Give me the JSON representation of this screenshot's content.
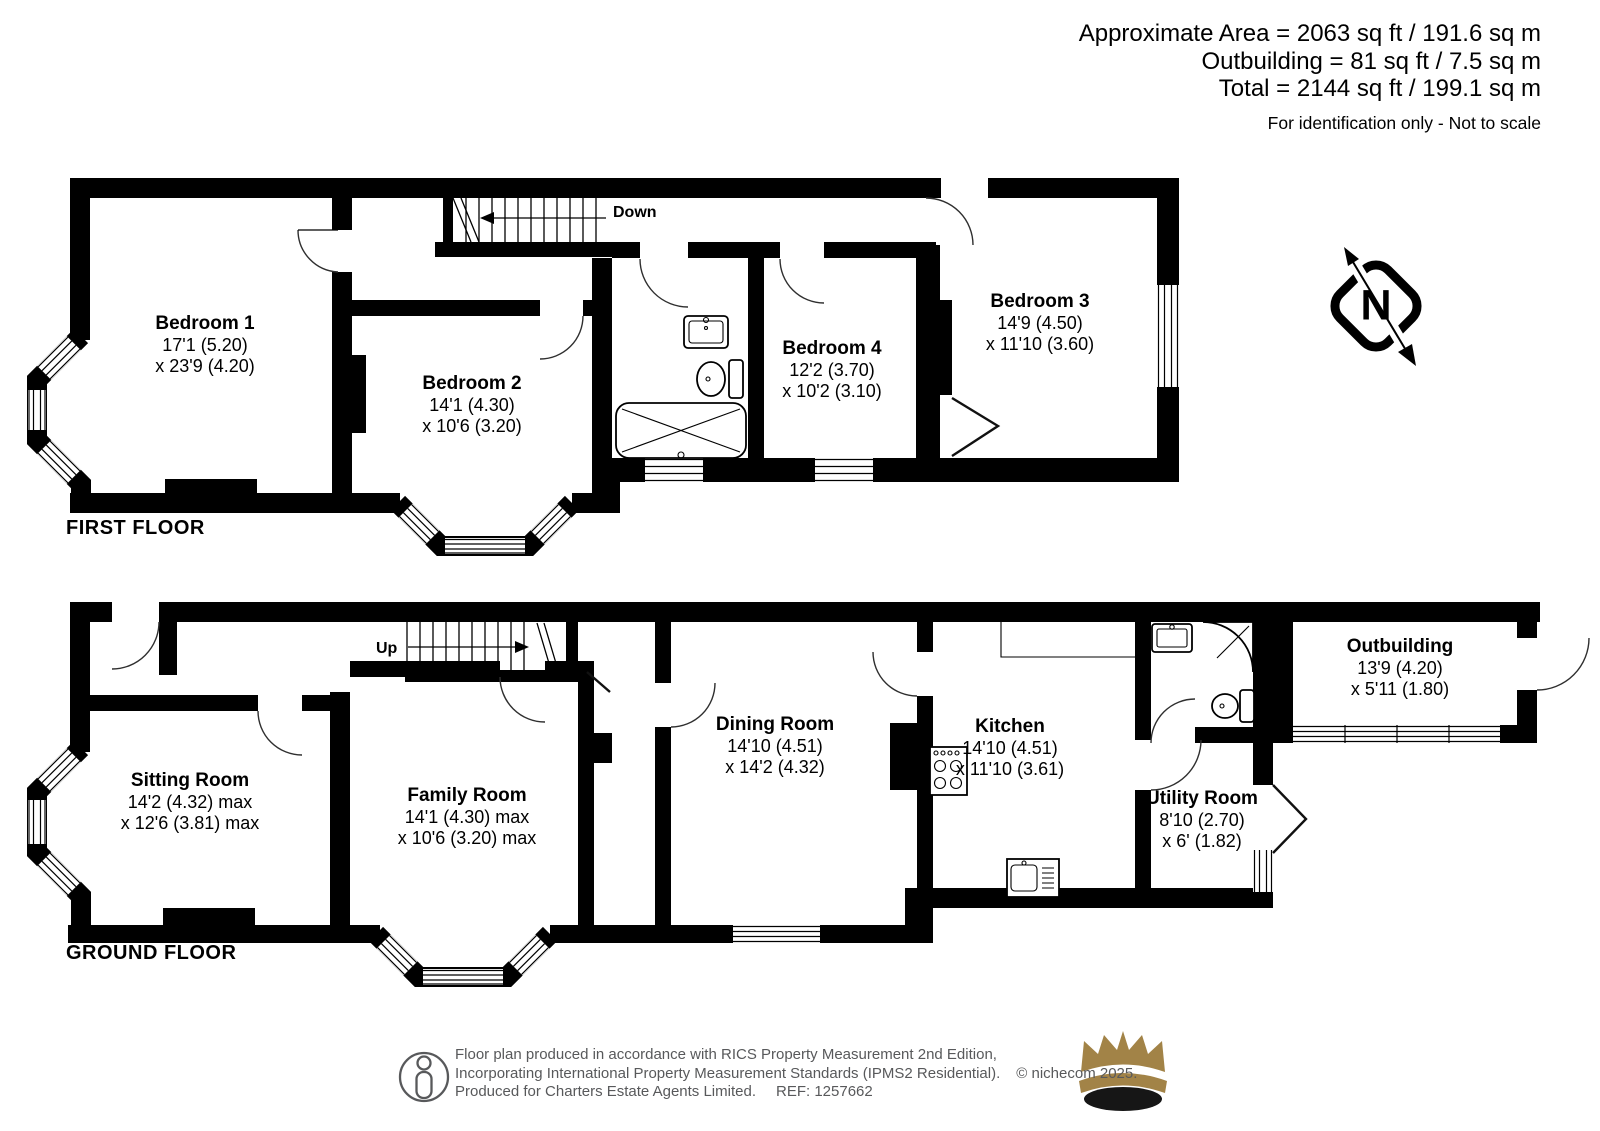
{
  "header": {
    "line1": "Approximate Area = 2063 sq ft / 191.6 sq m",
    "line2": "Outbuilding = 81 sq ft / 7.5 sq m",
    "line3": "Total = 2144 sq ft / 199.1 sq m",
    "disclaimer": "For identification only - Not to scale"
  },
  "first_floor": {
    "label": "FIRST FLOOR",
    "stairs_label": "Down",
    "rooms": [
      {
        "name": "Bedroom 1",
        "dim1": "17'1 (5.20)",
        "dim2": "x 23'9 (4.20)"
      },
      {
        "name": "Bedroom 2",
        "dim1": "14'1 (4.30)",
        "dim2": "x 10'6 (3.20)"
      },
      {
        "name": "Bedroom 4",
        "dim1": "12'2 (3.70)",
        "dim2": "x 10'2 (3.10)"
      },
      {
        "name": "Bedroom 3",
        "dim1": "14'9 (4.50)",
        "dim2": "x 11'10 (3.60)"
      }
    ]
  },
  "ground_floor": {
    "label": "GROUND FLOOR",
    "stairs_label": "Up",
    "rooms": [
      {
        "name": "Sitting Room",
        "dim1": "14'2 (4.32) max",
        "dim2": "x 12'6 (3.81) max"
      },
      {
        "name": "Family Room",
        "dim1": "14'1 (4.30) max",
        "dim2": "x 10'6 (3.20) max"
      },
      {
        "name": "Dining Room",
        "dim1": "14'10 (4.51)",
        "dim2": "x 14'2 (4.32)"
      },
      {
        "name": "Kitchen",
        "dim1": "14'10 (4.51)",
        "dim2": "x 11'10 (3.61)"
      },
      {
        "name": "Utility Room",
        "dim1": "8'10 (2.70)",
        "dim2": "x 6' (1.82)"
      },
      {
        "name": "Outbuilding",
        "dim1": "13'9 (4.20)",
        "dim2": "x 5'11 (1.80)"
      }
    ]
  },
  "compass": {
    "north_label": "N"
  },
  "footer": {
    "line1": "Floor plan produced in accordance with RICS Property Measurement 2nd Edition,",
    "line2": "Incorporating International Property Measurement Standards (IPMS2 Residential).",
    "copyright": "© nichecom 2025.",
    "line3a": "Produced for Charters Estate Agents Limited.",
    "line3b": "REF: 1257662"
  },
  "colors": {
    "wall": "#000000",
    "footer_text": "#58595b",
    "crown_gold": "#a28347"
  }
}
